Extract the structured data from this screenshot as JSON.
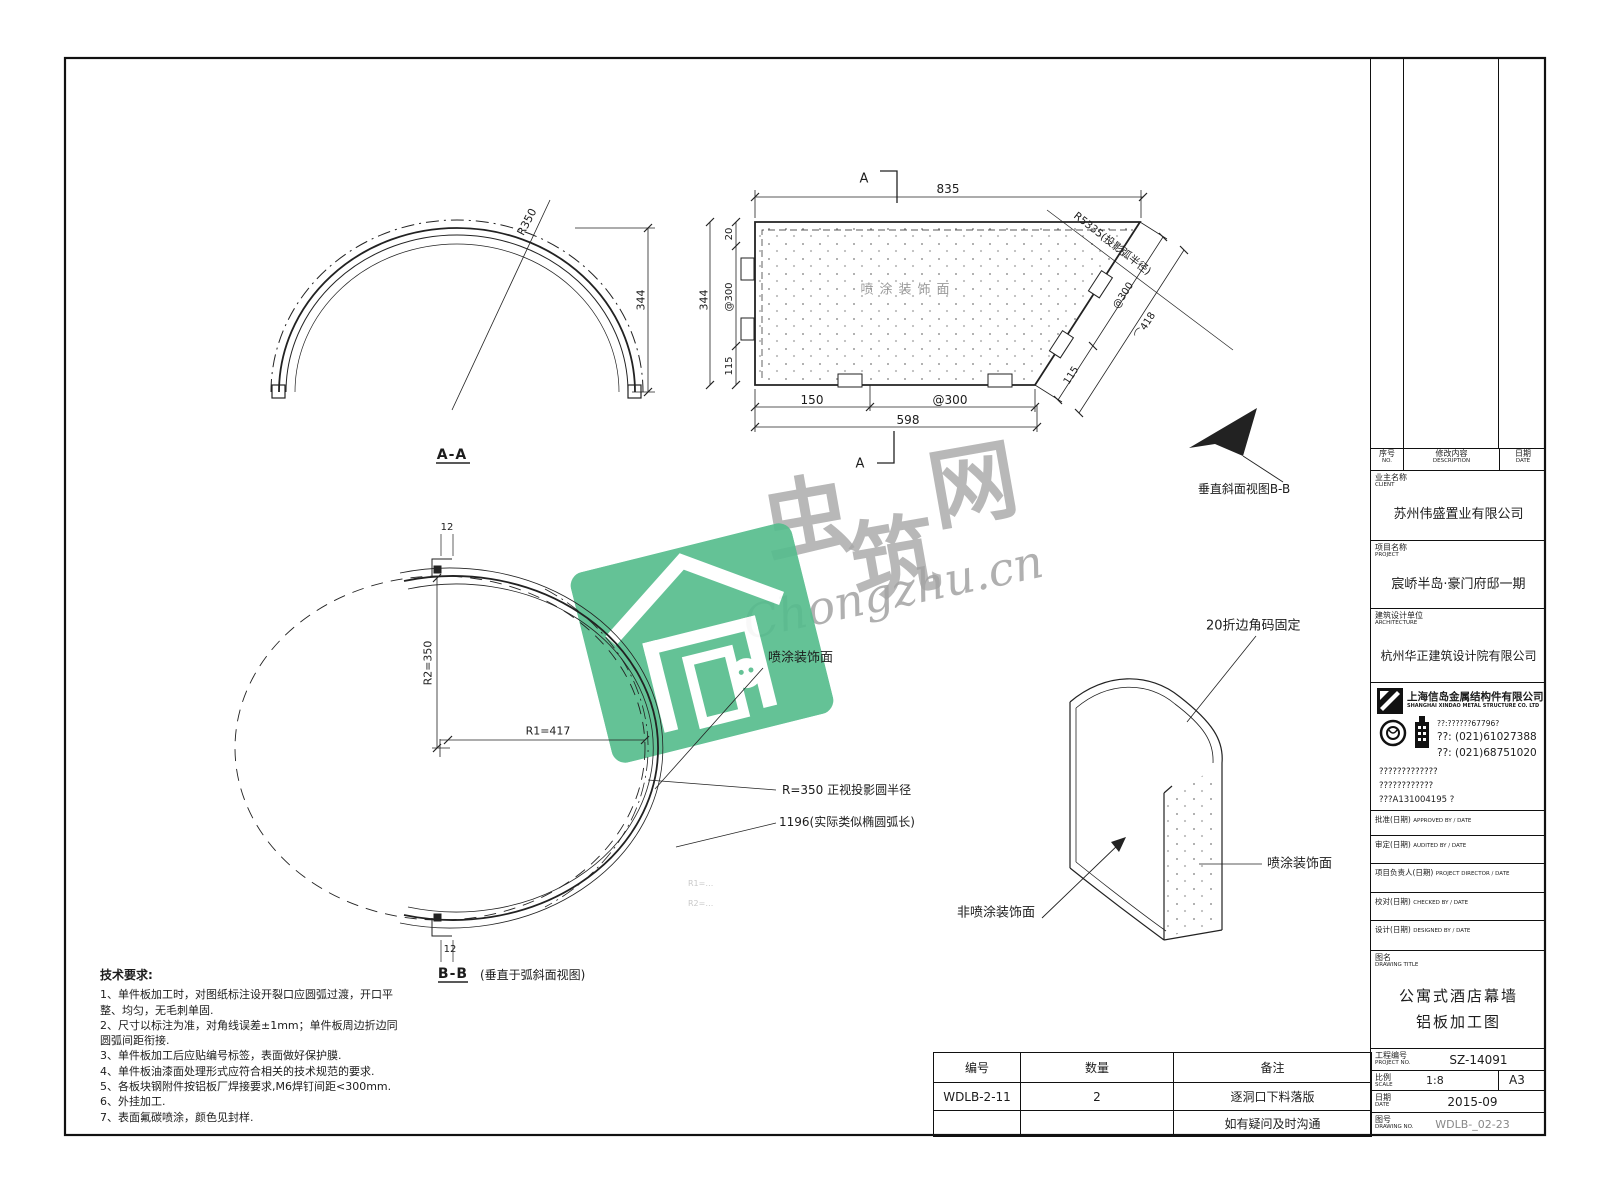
{
  "watermark": {
    "char1": "虫",
    "char2": "筑",
    "char3": "网",
    "url": "Chongzhu.cn"
  },
  "views": {
    "aa": {
      "title": "A-A",
      "radius": "R350",
      "height": "344"
    },
    "plan": {
      "marker_top": "A",
      "marker_bottom": "A",
      "dim_top": "835",
      "dim_left_total": "344",
      "dim_left_1": "20",
      "dim_left_2": "@300",
      "dim_left_3": "115",
      "dim_bottom_1": "150",
      "dim_bottom_2": "@300",
      "dim_bottom_total": "598",
      "dim_slant_1": "115",
      "dim_slant_2": "@300",
      "dim_slant_arc": "⌒418",
      "radius_note": "R5335(投影弧半径)",
      "face": "喷涂装饰面"
    },
    "bb_pointer": {
      "label": "垂直斜面视图B-B"
    },
    "bb": {
      "title": "B-B",
      "caption": "(垂直于弧斜面视图)",
      "r1": "R1=417",
      "r2": "R2=350",
      "thick_top": "12",
      "thick_bottom": "12",
      "face": "喷涂装饰面",
      "note_radius": "R=350 正视投影圆半径",
      "note_arc": "1196(实际类似椭圆弧长)",
      "faint_1": "R1=…",
      "faint_2": "R2=…"
    },
    "iso": {
      "fold": "20折边角码固定",
      "coated": "喷涂装饰面",
      "uncoated": "非喷涂装饰面"
    }
  },
  "notes": {
    "title": "技术要求:",
    "items": [
      "1、单件板加工时，对图纸标注设开裂口应圆弧过渡，开口平整、均匀，无毛刺单固.",
      "2、尺寸以标注为准，对角线误差±1mm；单件板周边折边同圆弧间距衔接.",
      "3、单件板加工后应贴编号标签，表面做好保护膜.",
      "4、单件板油漆面处理形式应符合相关的技术规范的要求.",
      "5、各板块钢附件按铝板厂焊接要求,M6焊钉间距<300mm.",
      "6、外挂加工.",
      "7、表面氟碳喷涂，颜色见封样."
    ]
  },
  "parts_table": {
    "headers": [
      "编号",
      "数量",
      "备注"
    ],
    "rows": [
      {
        "code": "WDLB-2-11",
        "qty": "2",
        "remark": "逐洞口下料落版"
      },
      {
        "code": "",
        "qty": "",
        "remark": "如有疑问及时沟通"
      }
    ]
  },
  "titleblock": {
    "revision": {
      "no_cn": "序号",
      "no_en": "NO.",
      "desc_cn": "修改内容",
      "desc_en": "DESCRIPTION",
      "date_cn": "日期",
      "date_en": "DATE"
    },
    "client": {
      "cn": "业主名称",
      "en": "CLIENT",
      "value": "苏州伟盛置业有限公司"
    },
    "project": {
      "cn": "项目名称",
      "en": "PROJECT",
      "value": "宸峤半岛·豪门府邸一期"
    },
    "architecture": {
      "cn": "建筑设计单位",
      "en": "ARCHITECTURE",
      "value": "杭州华正建筑设计院有限公司"
    },
    "company": {
      "name": "上海信岛金属结构件有限公司",
      "name_en": "SHANGHAI XINDAO METAL STRUCTURE CO. LTD",
      "line1": "??:??????67796?",
      "tel": "??:  (021)61027388",
      "fax": "??:  (021)68751020",
      "line4": "?????????????",
      "line5": "????????????",
      "line6": "???A131004195 ?"
    },
    "approvals": [
      {
        "cn": "批准(日期)",
        "en": "APPROVED BY / DATE"
      },
      {
        "cn": "审定(日期)",
        "en": "AUDITED BY / DATE"
      },
      {
        "cn": "项目负责人(日期)",
        "en": "PROJECT DIRECTOR / DATE"
      },
      {
        "cn": "校对(日期)",
        "en": "CHECKED BY / DATE"
      },
      {
        "cn": "设计(日期)",
        "en": "DESIGNED BY / DATE"
      }
    ],
    "drawing_title": {
      "cn": "图名",
      "en": "DRAWING TITLE",
      "line1": "公寓式酒店幕墙",
      "line2": "铝板加工图"
    },
    "project_no": {
      "cn": "工程编号",
      "en": "PROJECT NO.",
      "value": "SZ-14091"
    },
    "scale": {
      "cn": "比例",
      "en": "SCALE",
      "value": "1:8",
      "sheet": "A3"
    },
    "date": {
      "cn": "日期",
      "en": "DATE",
      "value": "2015-09"
    },
    "drawing_no": {
      "cn": "图号",
      "en": "DRAWING NO.",
      "value": "WDLB-_02-23"
    }
  }
}
